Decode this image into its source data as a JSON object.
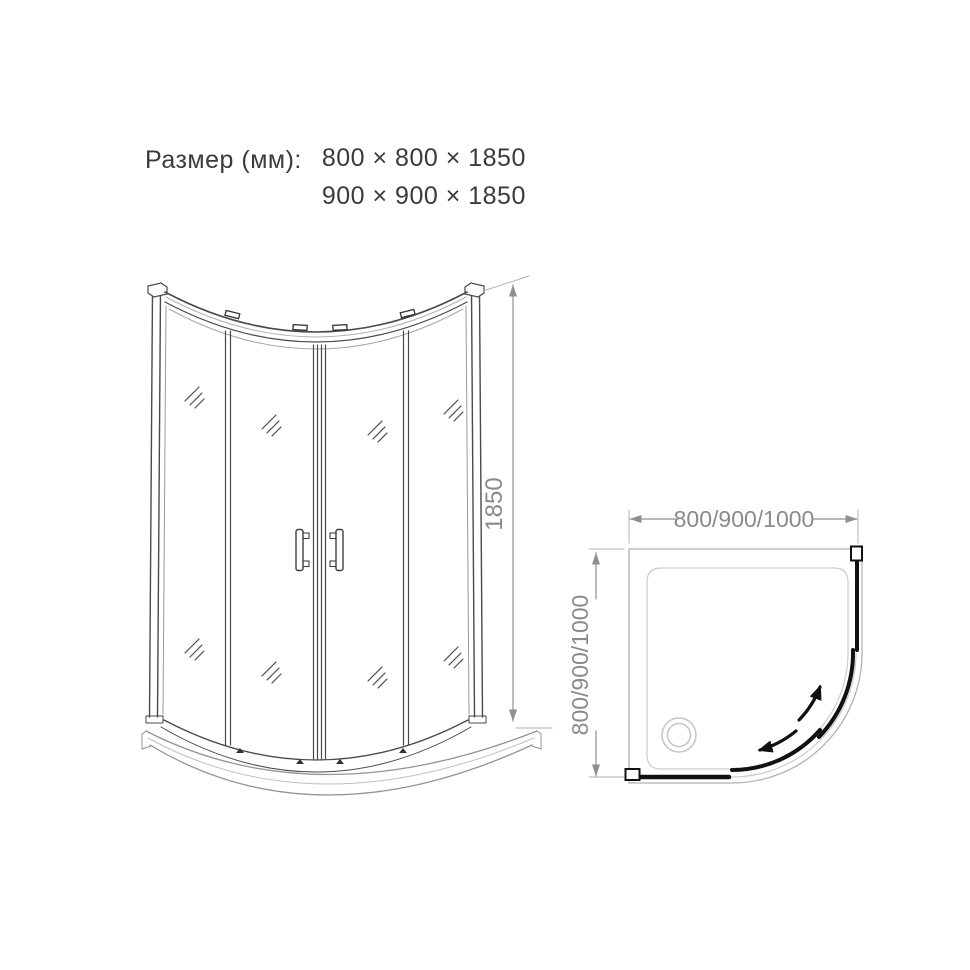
{
  "header": {
    "label": "Размер (мм):",
    "sizes": [
      "800 × 800 × 1850",
      "900 × 900 × 1850"
    ]
  },
  "front_view": {
    "height_dimension": "1850"
  },
  "top_view": {
    "width_dimension": "800/900/1000",
    "depth_dimension": "800/900/1000"
  },
  "icons": {
    "drain": "drain-icon",
    "slide_arrows": "door-slide-direction-arrows",
    "glass_shine": "glass-reflection-marks"
  },
  "colors": {
    "structure_dark": "#4a4a4a",
    "structure_light": "#b2b2b2",
    "tray_gray": "#949494",
    "panel_black": "#111111",
    "dimension_gray": "#8f8f8f",
    "text_dark": "#3b3b3b",
    "background": "#ffffff"
  }
}
